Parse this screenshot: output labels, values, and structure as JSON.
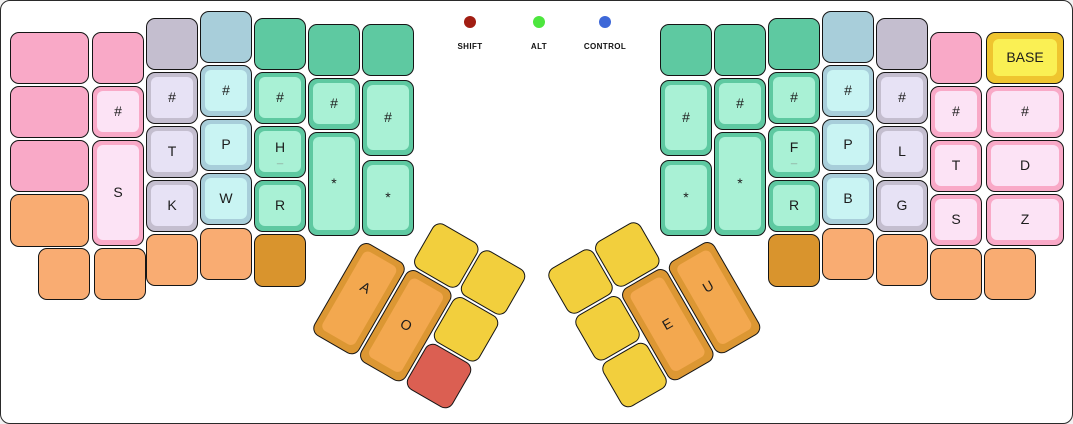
{
  "panel": {
    "background": "#ffffff",
    "border_color": "#2a2a2a"
  },
  "indicators": {
    "items": [
      {
        "name": "shift",
        "label": "SHIFT",
        "color": "#A11D12",
        "x": 469
      },
      {
        "name": "alt",
        "label": "ALT",
        "color": "#4DE63E",
        "x": 538
      },
      {
        "name": "control",
        "label": "CONTROL",
        "color": "#3E68D8",
        "x": 604
      }
    ]
  },
  "layer": {
    "current": "BASE"
  },
  "palette": {
    "pink": {
      "base": "#F9A9C7",
      "cap": "#FCE3F5"
    },
    "gray": {
      "base": "#C4BECF",
      "cap": "#E7E2F5"
    },
    "blue": {
      "base": "#A8CEDA",
      "cap": "#C9F4F3"
    },
    "green": {
      "base": "#5EC9A1",
      "cap": "#A9F1D5"
    },
    "orange": {
      "base": "#F9AC72",
      "cap": "#F9AC72"
    },
    "dark_orange": {
      "base": "#D9942D",
      "cap": "#D9942D"
    },
    "thumb_orange": {
      "base": "#DC9733",
      "cap": "#F3A84F",
      "thick": true
    },
    "yellow": {
      "base": "#F2CF3D",
      "cap": "#F2CF3D"
    },
    "red": {
      "base": "#DB5F52",
      "cap": "#DB5F52"
    },
    "layer_yellow": {
      "base": "#EFC52F",
      "cap": "#FAF054",
      "thick": true
    }
  },
  "keys": [
    {
      "name": "lh-col1-row1-key",
      "color": "pink",
      "label": "",
      "x": 9,
      "y": 31,
      "w": 79,
      "h": 52
    },
    {
      "name": "lh-col1-row2-key",
      "color": "pink",
      "label": "",
      "x": 9,
      "y": 85,
      "w": 79,
      "h": 52
    },
    {
      "name": "lh-col1-row3-key",
      "color": "pink",
      "label": "",
      "x": 9,
      "y": 139,
      "w": 79,
      "h": 52
    },
    {
      "name": "lh-col1-row4-key",
      "color": "orange",
      "label": "",
      "x": 9,
      "y": 193,
      "w": 79,
      "h": 53
    },
    {
      "name": "lh-col2-row1-key",
      "color": "pink",
      "label": "",
      "x": 91,
      "y": 31,
      "w": 52,
      "h": 52
    },
    {
      "name": "lh-col2-number-key",
      "color": "pink",
      "label": "#",
      "x": 91,
      "y": 85,
      "w": 52,
      "h": 52
    },
    {
      "name": "lh-s-key",
      "color": "pink",
      "label": "S",
      "x": 91,
      "y": 139,
      "w": 52,
      "h": 106
    },
    {
      "name": "lh-col3-row1-key",
      "color": "gray",
      "label": "",
      "x": 145,
      "y": 17,
      "w": 52,
      "h": 52
    },
    {
      "name": "lh-col3-number-key",
      "color": "gray",
      "label": "#",
      "x": 145,
      "y": 71,
      "w": 52,
      "h": 52
    },
    {
      "name": "lh-t-key",
      "color": "gray",
      "label": "T",
      "x": 145,
      "y": 125,
      "w": 52,
      "h": 52
    },
    {
      "name": "lh-k-key",
      "color": "gray",
      "label": "K",
      "x": 145,
      "y": 179,
      "w": 52,
      "h": 52
    },
    {
      "name": "lh-col4-row1-key",
      "color": "blue",
      "label": "",
      "x": 199,
      "y": 10,
      "w": 52,
      "h": 52
    },
    {
      "name": "lh-col4-number-key",
      "color": "blue",
      "label": "#",
      "x": 199,
      "y": 64,
      "w": 52,
      "h": 52
    },
    {
      "name": "lh-p-key",
      "color": "blue",
      "label": "P",
      "x": 199,
      "y": 118,
      "w": 52,
      "h": 52
    },
    {
      "name": "lh-w-key",
      "color": "blue",
      "label": "W",
      "x": 199,
      "y": 172,
      "w": 52,
      "h": 52
    },
    {
      "name": "lh-col5-row1-key",
      "color": "green",
      "label": "",
      "x": 253,
      "y": 17,
      "w": 52,
      "h": 52
    },
    {
      "name": "lh-col5-number-key",
      "color": "green",
      "label": "#",
      "x": 253,
      "y": 71,
      "w": 52,
      "h": 52
    },
    {
      "name": "lh-h-key",
      "color": "green",
      "label": "H",
      "label2": "_",
      "x": 253,
      "y": 125,
      "w": 52,
      "h": 52
    },
    {
      "name": "lh-r-key",
      "color": "green",
      "label": "R",
      "x": 253,
      "y": 179,
      "w": 52,
      "h": 52
    },
    {
      "name": "lh-col6-row1-key",
      "color": "green",
      "label": "",
      "x": 307,
      "y": 23,
      "w": 52,
      "h": 52
    },
    {
      "name": "lh-col6-number-key",
      "color": "green",
      "label": "#",
      "x": 307,
      "y": 77,
      "w": 52,
      "h": 52
    },
    {
      "name": "lh-star-key-1",
      "color": "green",
      "label": "*",
      "x": 307,
      "y": 131,
      "w": 52,
      "h": 104
    },
    {
      "name": "lh-col7-row1-key",
      "color": "green",
      "label": "",
      "x": 361,
      "y": 23,
      "w": 52,
      "h": 52
    },
    {
      "name": "lh-col7-number-key",
      "color": "green",
      "label": "#",
      "x": 361,
      "y": 79,
      "w": 52,
      "h": 76
    },
    {
      "name": "lh-star-key-2",
      "color": "green",
      "label": "*",
      "x": 361,
      "y": 159,
      "w": 52,
      "h": 76
    },
    {
      "name": "lh-bottom-key-1",
      "color": "orange",
      "label": "",
      "x": 37,
      "y": 247,
      "w": 52,
      "h": 52
    },
    {
      "name": "lh-bottom-key-2",
      "color": "orange",
      "label": "",
      "x": 93,
      "y": 247,
      "w": 52,
      "h": 52
    },
    {
      "name": "lh-bottom-key-3",
      "color": "orange",
      "label": "",
      "x": 145,
      "y": 233,
      "w": 52,
      "h": 52
    },
    {
      "name": "lh-bottom-key-4",
      "color": "orange",
      "label": "",
      "x": 199,
      "y": 227,
      "w": 52,
      "h": 52
    },
    {
      "name": "lh-bottom-key-5",
      "color": "dark_orange",
      "label": "",
      "x": 253,
      "y": 233,
      "w": 52,
      "h": 53
    },
    {
      "name": "rh-col1-row1-key",
      "color": "green",
      "label": "",
      "x": 659,
      "y": 23,
      "w": 52,
      "h": 52
    },
    {
      "name": "rh-col1-number-key",
      "color": "green",
      "label": "#",
      "x": 659,
      "y": 79,
      "w": 52,
      "h": 76
    },
    {
      "name": "rh-star-key-1",
      "color": "green",
      "label": "*",
      "x": 659,
      "y": 159,
      "w": 52,
      "h": 76
    },
    {
      "name": "rh-col2-row1-key",
      "color": "green",
      "label": "",
      "x": 713,
      "y": 23,
      "w": 52,
      "h": 52
    },
    {
      "name": "rh-col2-number-key",
      "color": "green",
      "label": "#",
      "x": 713,
      "y": 77,
      "w": 52,
      "h": 52
    },
    {
      "name": "rh-star-key-2",
      "color": "green",
      "label": "*",
      "x": 713,
      "y": 131,
      "w": 52,
      "h": 104
    },
    {
      "name": "rh-col3-row1-key",
      "color": "green",
      "label": "",
      "x": 767,
      "y": 17,
      "w": 52,
      "h": 52
    },
    {
      "name": "rh-col3-number-key",
      "color": "green",
      "label": "#",
      "x": 767,
      "y": 71,
      "w": 52,
      "h": 52
    },
    {
      "name": "rh-f-key",
      "color": "green",
      "label": "F",
      "label2": "_",
      "x": 767,
      "y": 125,
      "w": 52,
      "h": 52
    },
    {
      "name": "rh-r-key",
      "color": "green",
      "label": "R",
      "x": 767,
      "y": 179,
      "w": 52,
      "h": 52
    },
    {
      "name": "rh-col4-row1-key",
      "color": "blue",
      "label": "",
      "x": 821,
      "y": 10,
      "w": 52,
      "h": 52
    },
    {
      "name": "rh-col4-number-key",
      "color": "blue",
      "label": "#",
      "x": 821,
      "y": 64,
      "w": 52,
      "h": 52
    },
    {
      "name": "rh-p-key",
      "color": "blue",
      "label": "P",
      "x": 821,
      "y": 118,
      "w": 52,
      "h": 52
    },
    {
      "name": "rh-b-key",
      "color": "blue",
      "label": "B",
      "x": 821,
      "y": 172,
      "w": 52,
      "h": 52
    },
    {
      "name": "rh-col5-row1-key",
      "color": "gray",
      "label": "",
      "x": 875,
      "y": 17,
      "w": 52,
      "h": 52
    },
    {
      "name": "rh-col5-number-key",
      "color": "gray",
      "label": "#",
      "x": 875,
      "y": 71,
      "w": 52,
      "h": 52
    },
    {
      "name": "rh-l-key",
      "color": "gray",
      "label": "L",
      "x": 875,
      "y": 125,
      "w": 52,
      "h": 52
    },
    {
      "name": "rh-g-key",
      "color": "gray",
      "label": "G",
      "x": 875,
      "y": 179,
      "w": 52,
      "h": 52
    },
    {
      "name": "rh-col6-row1-key",
      "color": "pink",
      "label": "",
      "x": 929,
      "y": 31,
      "w": 52,
      "h": 52
    },
    {
      "name": "rh-col6-number-key",
      "color": "pink",
      "label": "#",
      "x": 929,
      "y": 85,
      "w": 52,
      "h": 52
    },
    {
      "name": "rh-t-key",
      "color": "pink",
      "label": "T",
      "x": 929,
      "y": 139,
      "w": 52,
      "h": 52
    },
    {
      "name": "rh-s-key",
      "color": "pink",
      "label": "S",
      "x": 929,
      "y": 193,
      "w": 52,
      "h": 52
    },
    {
      "name": "layer-indicator-base-key",
      "color": "layer_yellow",
      "label": "BASE",
      "x": 985,
      "y": 31,
      "w": 78,
      "h": 52
    },
    {
      "name": "rh-col7-number-key",
      "color": "pink",
      "label": "#",
      "x": 985,
      "y": 85,
      "w": 78,
      "h": 52
    },
    {
      "name": "rh-d-key",
      "color": "pink",
      "label": "D",
      "x": 985,
      "y": 139,
      "w": 78,
      "h": 52
    },
    {
      "name": "rh-z-key",
      "color": "pink",
      "label": "Z",
      "x": 985,
      "y": 193,
      "w": 78,
      "h": 52
    },
    {
      "name": "rh-bottom-key-1",
      "color": "dark_orange",
      "label": "",
      "x": 767,
      "y": 233,
      "w": 52,
      "h": 53
    },
    {
      "name": "rh-bottom-key-2",
      "color": "orange",
      "label": "",
      "x": 821,
      "y": 227,
      "w": 52,
      "h": 52
    },
    {
      "name": "rh-bottom-key-3",
      "color": "orange",
      "label": "",
      "x": 875,
      "y": 233,
      "w": 52,
      "h": 52
    },
    {
      "name": "rh-bottom-key-4",
      "color": "orange",
      "label": "",
      "x": 929,
      "y": 247,
      "w": 52,
      "h": 52
    },
    {
      "name": "rh-bottom-key-5",
      "color": "orange",
      "label": "",
      "x": 983,
      "y": 247,
      "w": 52,
      "h": 52
    }
  ],
  "thumb_clusters": [
    {
      "name": "left-thumb-cluster",
      "x": 389,
      "y": 192,
      "rotation": 30,
      "keys": [
        {
          "name": "lt-top-key-1",
          "color": "yellow",
          "label": "",
          "x": 54,
          "y": 0,
          "w": 52,
          "h": 52
        },
        {
          "name": "lt-top-key-2",
          "color": "yellow",
          "label": "",
          "x": 108,
          "y": 0,
          "w": 52,
          "h": 52
        },
        {
          "name": "lt-a-key",
          "color": "thumb_orange",
          "label": "A",
          "label_pos": "high",
          "x": 0,
          "y": 54,
          "w": 52,
          "h": 106
        },
        {
          "name": "lt-o-key",
          "color": "thumb_orange",
          "label": "O",
          "x": 54,
          "y": 54,
          "w": 52,
          "h": 106
        },
        {
          "name": "lt-side-key",
          "color": "yellow",
          "label": "",
          "x": 108,
          "y": 54,
          "w": 52,
          "h": 52
        },
        {
          "name": "lt-red-key",
          "color": "red",
          "label": "",
          "x": 108,
          "y": 108,
          "w": 52,
          "h": 52
        }
      ]
    },
    {
      "name": "right-thumb-cluster",
      "x": 544,
      "y": 271,
      "rotation": -30,
      "keys": [
        {
          "name": "rt-top-key-1",
          "color": "yellow",
          "label": "",
          "x": 0,
          "y": 0,
          "w": 52,
          "h": 52
        },
        {
          "name": "rt-top-key-2",
          "color": "yellow",
          "label": "",
          "x": 54,
          "y": 0,
          "w": 52,
          "h": 52
        },
        {
          "name": "rt-side-key-1",
          "color": "yellow",
          "label": "",
          "x": 0,
          "y": 54,
          "w": 52,
          "h": 52
        },
        {
          "name": "rt-side-key-2",
          "color": "yellow",
          "label": "",
          "x": 0,
          "y": 108,
          "w": 52,
          "h": 52
        },
        {
          "name": "rt-e-key",
          "color": "thumb_orange",
          "label": "E",
          "x": 54,
          "y": 54,
          "w": 52,
          "h": 106
        },
        {
          "name": "rt-u-key",
          "color": "thumb_orange",
          "label": "U",
          "label_pos": "high",
          "x": 108,
          "y": 54,
          "w": 52,
          "h": 106
        }
      ]
    }
  ]
}
